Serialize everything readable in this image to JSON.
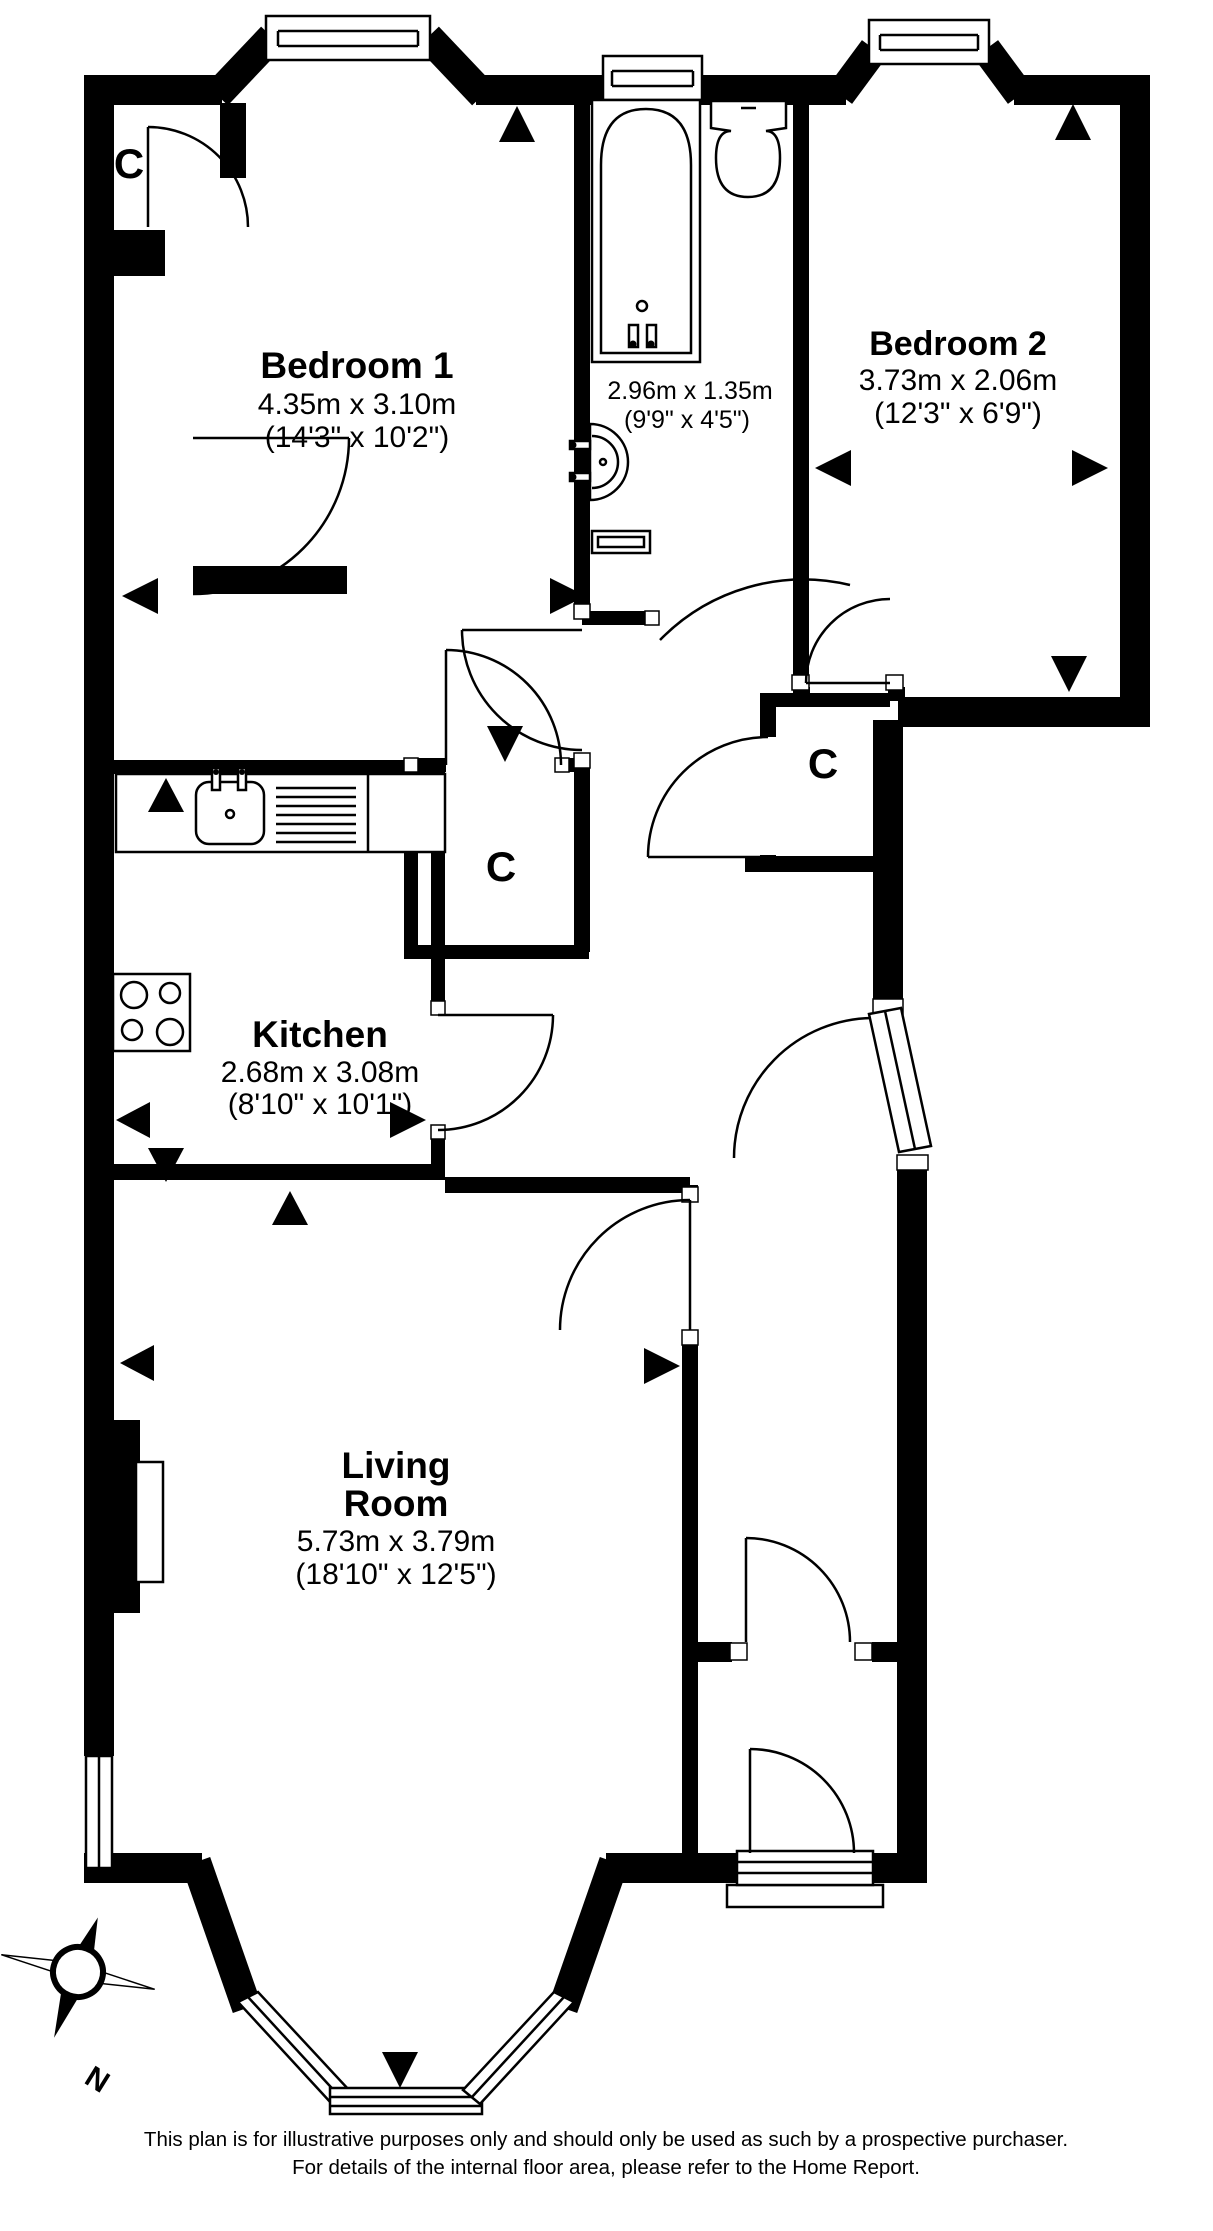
{
  "plan": {
    "rooms": {
      "bedroom1": {
        "name": "Bedroom 1",
        "metric": "4.35m x 3.10m",
        "imperial": "(14'3\" x 10'2\")"
      },
      "bedroom2": {
        "name": "Bedroom 2",
        "metric": "3.73m x 2.06m",
        "imperial": "(12'3\" x 6'9\")"
      },
      "bathroom": {
        "metric": "2.96m x 1.35m",
        "imperial": "(9'9\" x 4'5\")"
      },
      "kitchen": {
        "name": "Kitchen",
        "metric": "2.68m x 3.08m",
        "imperial": "(8'10\" x 10'1\")"
      },
      "living": {
        "name_line1": "Living",
        "name_line2": "Room",
        "metric": "5.73m x 3.79m",
        "imperial": "(18'10\" x 12'5\")"
      }
    },
    "closets": [
      {
        "label": "C"
      },
      {
        "label": "C"
      },
      {
        "label": "C"
      }
    ],
    "compass": {
      "north_label": "N"
    },
    "icons": {
      "fixtures": [
        "bathtub-icon",
        "toilet-icon",
        "basin-icon",
        "kitchen-sink-icon",
        "hob-icon",
        "fireplace-icon"
      ],
      "markers": "measurement-arrow-icon"
    },
    "colors": {
      "wall": "#000000",
      "background": "#ffffff",
      "text": "#000000"
    }
  },
  "footer": {
    "line1": "This plan is for illustrative purposes only and should only be used as such by a prospective purchaser.",
    "line2": "For details of the internal floor area, please refer to the Home Report."
  }
}
